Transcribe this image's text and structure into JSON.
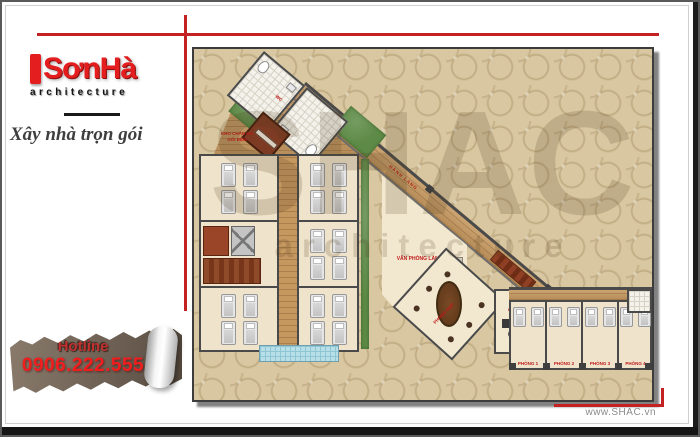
{
  "brand": {
    "logo_text": "SơnHà",
    "logo_sub": "architecture",
    "slogan": "Xây nhà trọn gói"
  },
  "hotline": {
    "label": "Hotline",
    "number": "0906.222.555"
  },
  "footer": {
    "website": "www.SHAC.vn"
  },
  "watermark": {
    "line1": "SHAC",
    "line2": "architecture"
  },
  "plan": {
    "labels": {
      "storage_line1": "KHO CHĂN GA",
      "storage_line2": "GỐI ĐỆM",
      "wc": "WC",
      "corridor": "HÀNH LANG",
      "office": "VĂN PHÒNG LÀM VIỆC",
      "meeting": "PHÒNG HỌP",
      "director": "P.GIÁM ĐỐC"
    },
    "rooms": [
      {
        "label": "PHÒNG 1"
      },
      {
        "label": "PHÒNG 2"
      },
      {
        "label": "PHÒNG 3"
      },
      {
        "label": "PHÒNG 4"
      }
    ]
  },
  "colors": {
    "accent_red": "#c42222",
    "logo_red": "#e41e1e",
    "hotline_red": "#f21d1d",
    "banner_brown": "#75675a",
    "pattern_beige": "#d8c7a0",
    "wood": "#c5985f",
    "floor_cream": "#efe4cb",
    "wall_gray": "#4a4a4a",
    "plant_green": "#5d8a46",
    "canopy_blue": "#b8dfe8",
    "label_red": "#c01818"
  }
}
